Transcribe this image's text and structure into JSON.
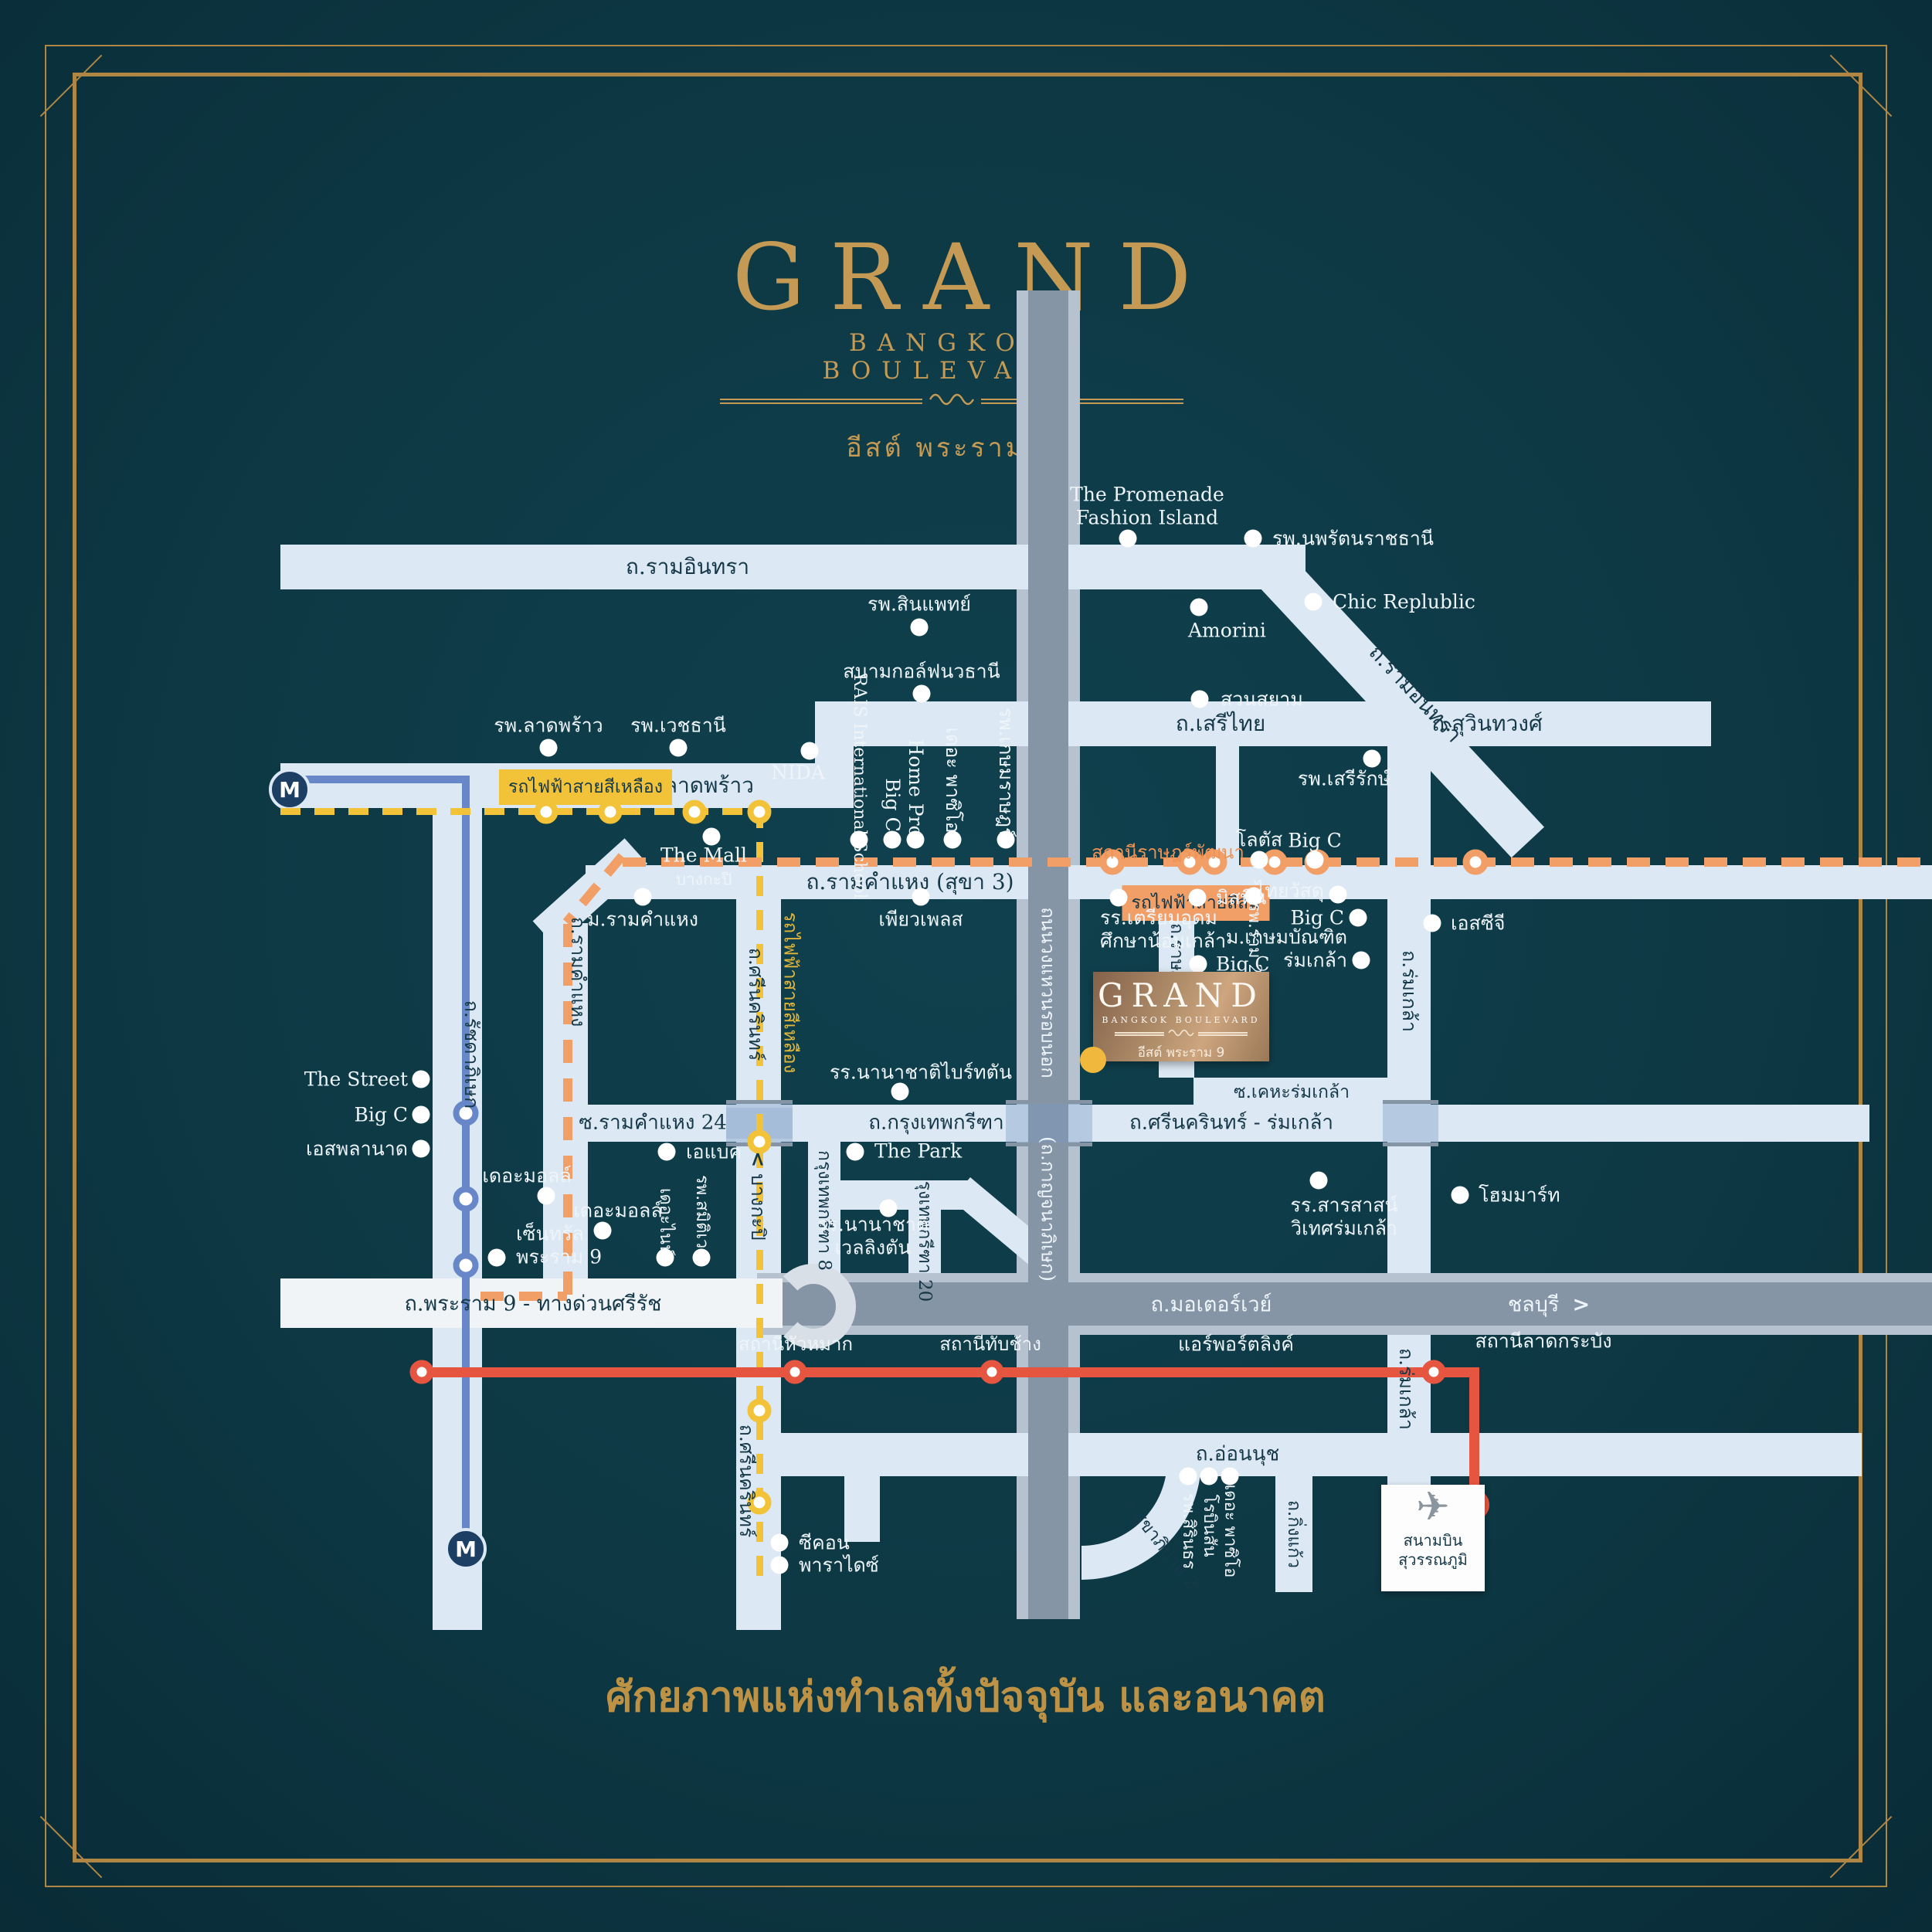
{
  "brand": {
    "name": "GRAND",
    "tagline": "BANGKOK BOULEVARD",
    "location": "อีสต์ พระราม 9"
  },
  "project": {
    "name": "GRAND",
    "tagline": "BANGKOK BOULEVARD",
    "location": "อีสต์ พระราม 9"
  },
  "footer": {
    "tagline": "ศักยภาพแห่งทำเลทั้งปัจจุบัน และอนาคต"
  },
  "airport": {
    "name": "สนามบิน\nสุวรรณภูมิ",
    "plane_icon": "✈"
  },
  "transit": {
    "yellow_line_badge": "รถไฟฟ้าสายสีเหลือง",
    "yellow_line_vertical": "รถไฟฟ้าสายสีเหลือง",
    "orange_line_badge": "รถไฟฟ้าสายสีส้ม",
    "ratphatthana_station": "สถานีราษฎร์พัฒนา",
    "airport_link": "แอร์พอร์ตลิงค์",
    "huamak_station": "สถานีหัวหมาก",
    "thapchang_station": "สถานีทับช้าง",
    "latkrabang_station": "สถานีลาดกระบัง",
    "mrt_symbol": "M",
    "colors": {
      "yellow": "#f2c338",
      "orange": "#f29e67",
      "red": "#e65540",
      "blue": "#6787c8",
      "gold": "#c49a55"
    }
  },
  "roads": {
    "ramintra": "ถ.รามอินทรา",
    "ramintra_diag": "ถ.รามอินทรา",
    "latphrao": "ถ.ลาดพร้าว",
    "serithai": "ถ.เสรีไทย",
    "suwinthawong": "ถ.สุวินทวงศ์",
    "ramkhamhaeng": "ถ.รามคำแหง (สุขา 3)",
    "ramkhamhaeng_v": "ถ.รามคำแหง",
    "ratchadaphisek": "ถ.รัชดาภิเษก",
    "srinakarin": "ถ.ศรีนครินทร์",
    "srinakarin_s": "ถ.ศรีนครินทร์",
    "bangkapi_dir": "บางกะปิ",
    "chonburi_dir": "ชลบุรี",
    "ram24": "ซ.รามคำแหง 24",
    "krungthep_kreetha": "ถ.กรุงเทพกรีฑา",
    "srinakarin_romklao": "ถ.ศรีนครินทร์ - ร่มเกล้า",
    "keha_romklao": "ซ.เคหะร่มเกล้า",
    "ratphatthana": "ถ.ราษฎร์พัฒนา",
    "romklao": "ถ.ร่มเกล้า",
    "romklao_s": "ถ.ร่มเกล้า",
    "ringroad": "ถนนวงแหวนรอบนอก",
    "kanchanaphisek": "(ถ.กาญจนาภิเษก)",
    "rama9": "ถ.พระราม 9 - ทางด่วนศรีรัช",
    "motorway": "ถ.มอเตอร์เวย์",
    "onnut": "ถ.อ่อนนุช",
    "sukhapibal2": "ถ.สุขาภิบาล 2",
    "kingkaew": "ถ.กิ่งแก้ว",
    "kreetha8": "กรุงเทพกรีฑา 8",
    "kreetha20": "กรุงเทพกรีฑา 20"
  },
  "landmarks": {
    "promenade": "The Promenade\nFashion Island",
    "noparat": "รพ.นพรัตนราชธานี",
    "chic": "Chic Replublic",
    "amorini": "Amorini",
    "suansiam": "สวนสยาม",
    "sinphaet": "รพ.สินแพทย์",
    "golf": "สนามกอล์ฟนวธานี",
    "latphrao_hosp": "รพ.ลาดพร้าว",
    "vejthani": "รพ.เวชธานี",
    "themall_bk1": "The Mall",
    "themall_bk2": "บางกะปิ",
    "nida": "NIDA",
    "rais": "RAIS\nInternational\nSchool",
    "bigc_rk": "Big C",
    "homepro": "Home Pro",
    "paseo_rk": "เดอะ พาซิโอ",
    "kasemrad": "รพ.เกษมราษฎร์",
    "pureplace": "เพียวเพลส",
    "ram_university": "ม.รามคำแหง",
    "mistine": "มิสทีน",
    "ram2": "รพ.ราม 2",
    "thaiwatsadu": "ไทยวัสดุ",
    "bigc_tw": "Big C",
    "kasembundit": "ม.เกษมบัณฑิต\nร่มเกล้า",
    "bigc_keha": "Big C",
    "lotus": "โลตัส",
    "bigc_lotus": "Big C",
    "serirak": "รพ.เสรีรักษ์",
    "scg": "เอสซีจี",
    "triamudom": "รร.เตรียมอุดม\nศึกษาน้อมเกล้า",
    "hommart": "โฮมมาร์ท",
    "sarasas": "รร.สารสาสน์\nวิเทศร่มเกล้า",
    "thepark": "The Park",
    "brighton": "รร.นานาชาติไบร์ทตัน",
    "wellington": "รร.นานาชาติ\nเวลลิงตัน",
    "abac": "เอแบค",
    "themall1": "เดอะมอลล์",
    "themall2": "เดอะมอลล์",
    "central": "เซ็นทรัล\nพระราม 9",
    "street": "The Street",
    "bigc_street": "Big C",
    "esplanade": "เอสพลานาด",
    "thenine": "เดอะไนน์",
    "samitivej": "รพ.สมิติเวช",
    "seacon": "ซีคอน",
    "paradise": "พาราไดซ์",
    "sirindhorn": "รพ.สิรินธร",
    "robinson": "โรบินสัน",
    "paseo_onnut": "เดอะ พาซิโอ"
  }
}
